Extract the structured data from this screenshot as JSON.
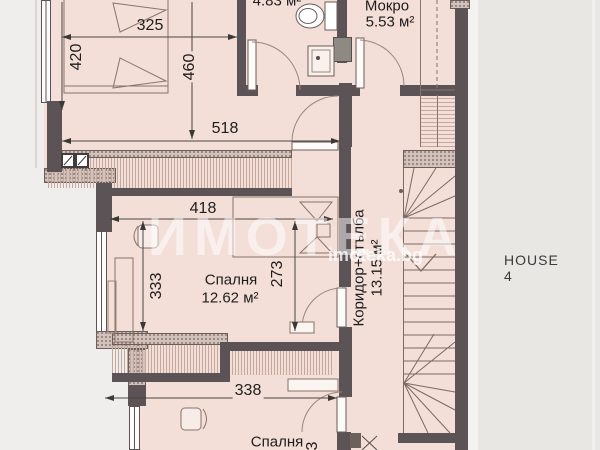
{
  "watermark": {
    "big": "ИМОТЕКА",
    "small": "imoteka.bg"
  },
  "outside": {
    "house_label": "HOUSE  4"
  },
  "rooms": {
    "bathroom": {
      "area": "4.83 м²"
    },
    "mokro": {
      "name": "Мокро",
      "area": "5.53 м²"
    },
    "bedroom_mid": {
      "name": "Спалня",
      "area": "12.62 м²"
    },
    "corridor": {
      "name": "Коридор+стълба",
      "area": "13.15 м²"
    },
    "bedroom_bottom": {
      "name": "Спалня",
      "partial_dim": "3"
    }
  },
  "dims": {
    "w325": "325",
    "h420": "420",
    "h460": "460",
    "w518": "518",
    "w418": "418",
    "h333": "333",
    "h273": "273",
    "w338": "338"
  },
  "colors": {
    "floor": "#f3ded8",
    "wall": "#5b5355",
    "outside": "#e8e7e4",
    "accent_line": "#4a4642"
  }
}
